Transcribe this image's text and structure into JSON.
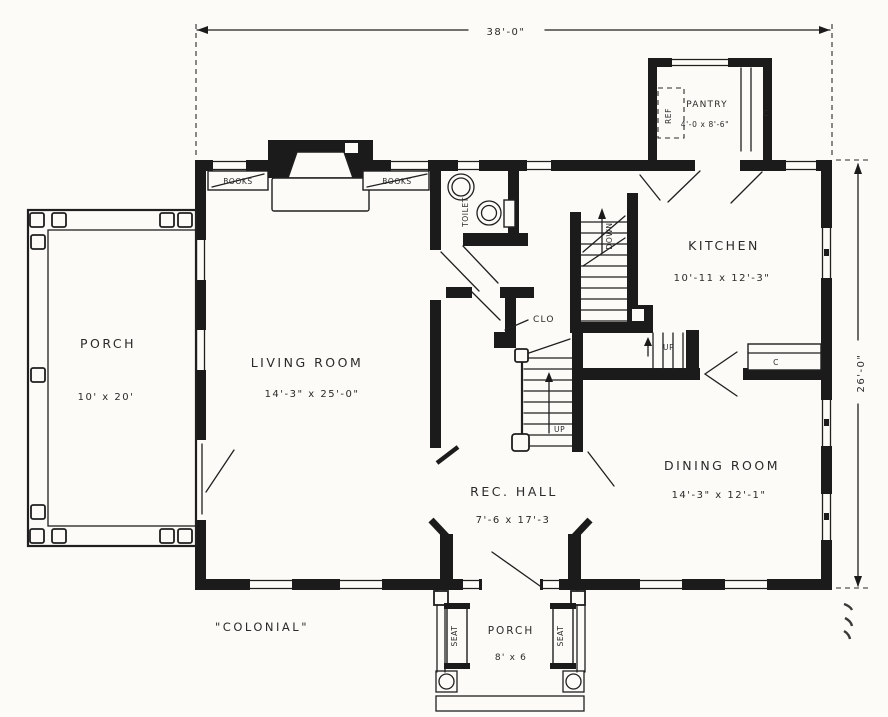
{
  "title": "Colonial house first-floor plan",
  "plan": {
    "style_label": "\"COLONIAL\"",
    "overall_width": "38'-0\"",
    "overall_depth": "26'-0\"",
    "rooms": {
      "side_porch": {
        "name": "PORCH",
        "size": "10' x 20'"
      },
      "living_room": {
        "name": "LIVING ROOM",
        "size": "14'-3\" x 25'-0\""
      },
      "rec_hall": {
        "name": "REC. HALL",
        "size": "7'-6 x 17'-3"
      },
      "dining_room": {
        "name": "DINING ROOM",
        "size": "14'-3\" x 12'-1\""
      },
      "kitchen": {
        "name": "KITCHEN",
        "size": "10'-11 x 12'-3\""
      },
      "pantry": {
        "name": "PANTRY",
        "size": "4'-0 x 8'-6\""
      },
      "front_porch": {
        "name": "PORCH",
        "size": "8' x 6"
      }
    },
    "features": {
      "toilet": "TOILET",
      "closet": "CLO",
      "books_left": "BOOKS",
      "books_right": "BOOKS",
      "seat_left": "SEAT",
      "seat_right": "SEAT",
      "refrigerator": "REF",
      "pantry_cupboard": "C",
      "kitchen_counter": "C",
      "stairs_up_main": "UP",
      "stairs_up_back": "UP",
      "stairs_down": "DOWN"
    },
    "colors": {
      "paper": "#fcfbf7",
      "ink": "#1b1b1b"
    }
  }
}
